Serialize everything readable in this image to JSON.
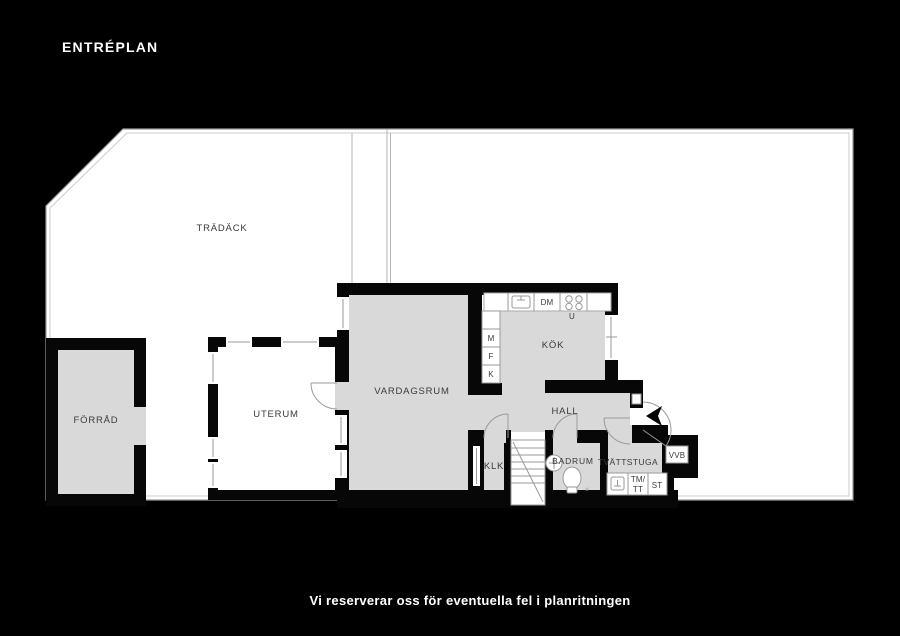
{
  "title": "ENTRÉPLAN",
  "footer": {
    "disclaimer": "Vi reserverar oss för eventuella fel i planritningen"
  },
  "colors": {
    "background": "#000000",
    "deck": "#ffffff",
    "room_fill": "#d9d9d9",
    "wall": "#070707",
    "outline": "#9a9a9a",
    "label_text": "#3a3a3a",
    "title_text": "#ffffff"
  },
  "rooms": {
    "tradack": "TRÄDÄCK",
    "forrad": "FÖRRÅD",
    "uterum": "UTERUM",
    "vardagsrum": "VARDAGSRUM",
    "kok": "KÖK",
    "hall": "HALL",
    "klk": "KLK",
    "badrum": "BADRUM",
    "tvattstuga": "TVÄTTSTUGA"
  },
  "labels": {
    "dm": "DM",
    "u": "U",
    "m": "M",
    "f": "F",
    "k": "K",
    "tm_line1": "TM/",
    "tm_line2": "TT",
    "st": "ST",
    "vvb": "VVB"
  }
}
